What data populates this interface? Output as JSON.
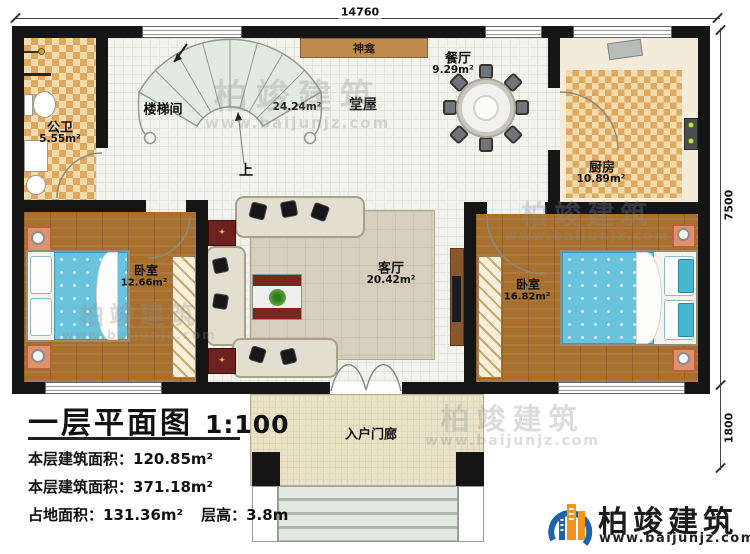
{
  "plan": {
    "dims": {
      "width_mm": "14760",
      "height_upper_mm": "7500",
      "height_lower_mm": "1800"
    },
    "rooms": {
      "bathroom": {
        "name": "公卫",
        "area": "5.55m²"
      },
      "stairwell": {
        "name": "楼梯间"
      },
      "shrine": {
        "name": "神龛"
      },
      "hall": {
        "name": "堂屋",
        "area": "24.24m²"
      },
      "dining": {
        "name": "餐厅",
        "area": "9.29m²"
      },
      "kitchen": {
        "name": "厨房",
        "area": "10.89m²"
      },
      "bedroom_left": {
        "name": "卧室",
        "area": "12.66m²"
      },
      "bedroom_right": {
        "name": "卧室",
        "area": "16.82m²"
      },
      "living": {
        "name": "客厅",
        "area": "20.42m²"
      },
      "porch": {
        "name": "入户门廊"
      }
    },
    "stair_up_label": "上"
  },
  "title_block": {
    "title": "一层平面图",
    "scale": "1:100",
    "stats": [
      {
        "label": "本层建筑面积：",
        "value": "120.85m²"
      },
      {
        "label": "本层建筑面积：",
        "value": "371.18m²"
      },
      {
        "label": "占地面积：",
        "value": "131.36m²",
        "label2": "层高：",
        "value2": "3.8m"
      }
    ]
  },
  "branding": {
    "name": "柏竣建筑",
    "url": "www.baijunjz.com"
  },
  "watermark": {
    "name": "柏竣建筑",
    "url": "www.baijunjz.com"
  },
  "colors": {
    "wall": "#151515",
    "checker": "#e0a85e",
    "wood": "#a8702f",
    "bed_blue": "#69c3dc",
    "shrine_brown": "#bd8b4d",
    "logo_blue": "#1d63ad",
    "logo_orange": "#f0941d"
  }
}
